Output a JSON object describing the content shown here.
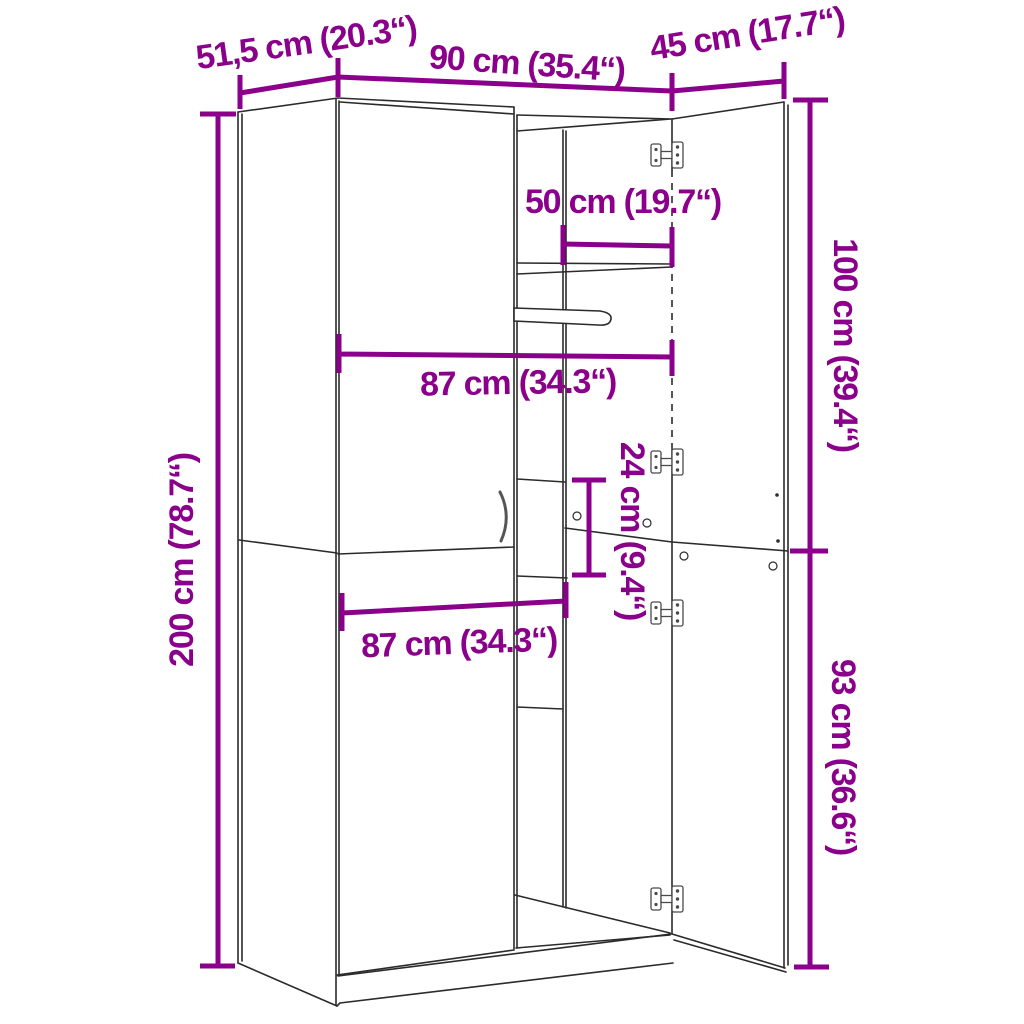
{
  "diagram": {
    "type": "furniture-dimension-diagram",
    "subject": "two-door wardrobe with open right doors, shelf, clothes rail and hinges",
    "colors": {
      "dimension": "#8B008B",
      "outline": "#2b2b2b",
      "hardware": "#4a4a4a",
      "background": "#ffffff"
    },
    "labels": {
      "depth": "51,5 cm (20.3“)",
      "width": "90 cm (35.4“)",
      "door_width": "45 cm (17.7“)",
      "shelf_width": "50 cm (19.7“)",
      "interior_width_upper": "87 cm (34.3“)",
      "cubby_height": "24 cm (9.4“)",
      "height": "200 cm (78.7“)",
      "upper_section_height": "100 cm (39.4“)",
      "lower_section_height": "93 cm (36.6“)",
      "interior_width_lower": "87 cm (34.3“)"
    },
    "values_cm": {
      "depth": 51.5,
      "width": 90,
      "door_width": 45,
      "shelf_width": 50,
      "interior_width": 87,
      "cubby_height": 24,
      "height": 200,
      "upper_section_height": 100,
      "lower_section_height": 93
    }
  }
}
